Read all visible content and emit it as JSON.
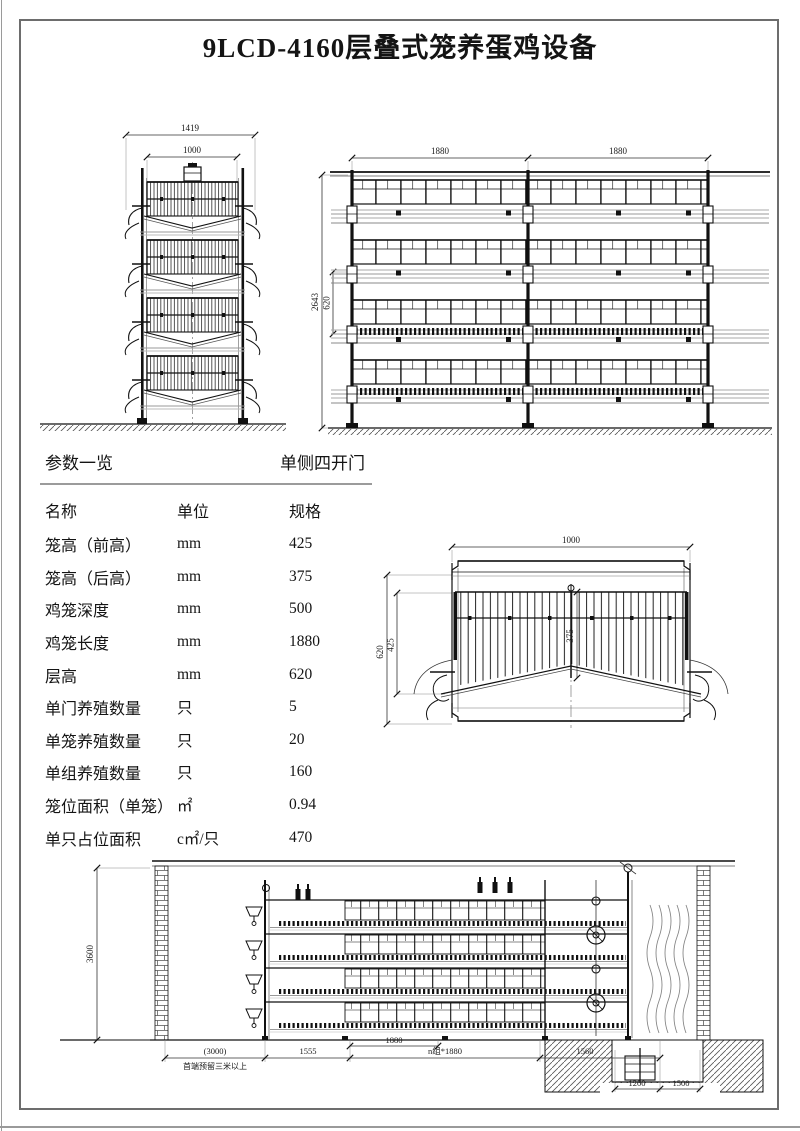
{
  "page": {
    "title": "9LCD-4160层叠式笼养蛋鸡设备"
  },
  "params": {
    "section_title": "参数一览",
    "section_subtitle": "单侧四开门",
    "columns": [
      "名称",
      "单位",
      "规格"
    ],
    "rows": [
      {
        "name": "笼高（前高）",
        "unit": "mm",
        "value": "425"
      },
      {
        "name": "笼高（后高）",
        "unit": "mm",
        "value": "375"
      },
      {
        "name": "鸡笼深度",
        "unit": "mm",
        "value": "500"
      },
      {
        "name": "鸡笼长度",
        "unit": "mm",
        "value": "1880"
      },
      {
        "name": "层高",
        "unit": "mm",
        "value": "620"
      },
      {
        "name": "单门养殖数量",
        "unit": "只",
        "value": "5"
      },
      {
        "name": "单笼养殖数量",
        "unit": "只",
        "value": "20"
      },
      {
        "name": "单组养殖数量",
        "unit": "只",
        "value": "160"
      },
      {
        "name": "笼位面积（单笼）",
        "unit": "㎡",
        "value": "0.94"
      },
      {
        "name": "单只占位面积",
        "unit": "c㎡/只",
        "value": "470"
      }
    ]
  },
  "drawings": {
    "side_view": {
      "overall_width": "1419",
      "inner_width": "1000"
    },
    "front_view": {
      "bay1_width": "1880",
      "bay2_width": "1880",
      "overall_height": "2643",
      "tier_pitch": "620"
    },
    "cage_detail": {
      "width": "1000",
      "tier_pitch": "620",
      "front_height": "425",
      "back_height": "375"
    },
    "installation": {
      "house_height": "3600",
      "head_clearance": "(3000)",
      "head_note": "首端预留三米以上",
      "front_section": "1555",
      "bay_width": "1880",
      "bay_run": "n组*1880",
      "rear_section": "1560",
      "pit_width": "1200",
      "pit_ledge": "1500"
    }
  }
}
